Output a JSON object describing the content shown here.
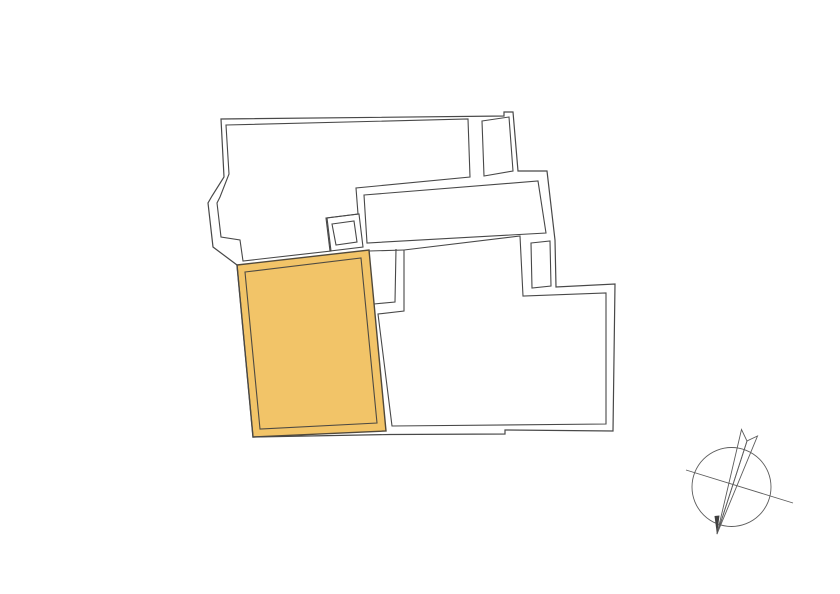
{
  "canvas": {
    "width": 840,
    "height": 594,
    "background": "#ffffff"
  },
  "colors": {
    "wall_stroke": "#484848",
    "highlight_fill": "#f2c468",
    "highlight_outer_stroke": "#51493a",
    "highlight_inner_stroke": "#4e4a42",
    "compass_stroke": "#5c5c5c",
    "compass_tip_fill": "#3f3f3f"
  },
  "floorplan": {
    "outer_boundary": {
      "closed": true,
      "points": [
        [
          221,
          119
        ],
        [
          504,
          116
        ],
        [
          504,
          112
        ],
        [
          513,
          112
        ],
        [
          518,
          171
        ],
        [
          547,
          171
        ],
        [
          555,
          240
        ],
        [
          556,
          287
        ],
        [
          615,
          284
        ],
        [
          613,
          431
        ],
        [
          505,
          430
        ],
        [
          505,
          434
        ],
        [
          390,
          434.5
        ],
        [
          253,
          437
        ],
        [
          237,
          265
        ],
        [
          213,
          247
        ],
        [
          208,
          203
        ],
        [
          212,
          196
        ],
        [
          224,
          177
        ]
      ]
    },
    "rooms": [
      {
        "name": "room-upper-left",
        "closed": true,
        "points": [
          [
            226,
            125
          ],
          [
            468,
            119
          ],
          [
            470,
            177
          ],
          [
            356,
            188
          ],
          [
            358,
            214
          ],
          [
            327,
            218
          ],
          [
            331,
            251
          ],
          [
            243,
            261
          ],
          [
            240,
            240
          ],
          [
            221,
            237
          ],
          [
            217,
            203
          ],
          [
            220,
            197
          ],
          [
            229,
            174
          ]
        ]
      },
      {
        "name": "room-top-right",
        "closed": true,
        "points": [
          [
            482,
            121
          ],
          [
            509,
            117
          ],
          [
            513,
            171
          ],
          [
            484,
            176
          ]
        ]
      },
      {
        "name": "room-middle-band",
        "closed": true,
        "points": [
          [
            364,
            195
          ],
          [
            538,
            181
          ],
          [
            546,
            233
          ],
          [
            367,
            243
          ]
        ]
      },
      {
        "name": "room-square-outer",
        "closed": true,
        "points": [
          [
            326,
            218
          ],
          [
            359,
            214
          ],
          [
            363,
            247
          ],
          [
            330,
            251
          ]
        ]
      },
      {
        "name": "room-square-inner",
        "closed": true,
        "points": [
          [
            332,
            224
          ],
          [
            354,
            221
          ],
          [
            357,
            242
          ],
          [
            336,
            245
          ]
        ]
      },
      {
        "name": "room-shaft",
        "closed": true,
        "points": [
          [
            531,
            243
          ],
          [
            550,
            241
          ],
          [
            551,
            286
          ],
          [
            532,
            288
          ]
        ]
      },
      {
        "name": "room-lower-right",
        "closed": true,
        "points": [
          [
            404,
            250
          ],
          [
            520,
            236
          ],
          [
            523,
            296
          ],
          [
            606,
            293
          ],
          [
            606,
            424
          ],
          [
            392,
            426
          ],
          [
            378,
            314
          ],
          [
            404,
            311
          ]
        ]
      }
    ],
    "wall_segments": [
      {
        "name": "wall-seg-band-bottom-left",
        "closed": false,
        "points": [
          [
            369,
            251
          ],
          [
            404,
            250
          ]
        ]
      },
      {
        "name": "wall-seg-stub-left",
        "closed": false,
        "points": [
          [
            374,
            304
          ],
          [
            395,
            302
          ],
          [
            396,
            249
          ]
        ]
      }
    ],
    "highlight_room": {
      "outer": {
        "closed": true,
        "points": [
          [
            237,
            265
          ],
          [
            369,
            250
          ],
          [
            386,
            431
          ],
          [
            253,
            437
          ]
        ]
      },
      "inner": {
        "closed": true,
        "points": [
          [
            245,
            272
          ],
          [
            361,
            258
          ],
          [
            377,
            423
          ],
          [
            260,
            429
          ]
        ]
      }
    }
  },
  "compass": {
    "center": [
      731.5,
      487
    ],
    "radius": 39.5,
    "cross_line": [
      [
        686,
        470
      ],
      [
        793,
        503
      ]
    ],
    "needle": {
      "tip": [
        717,
        534
      ],
      "left_prong": [
        741.5,
        429.5
      ],
      "right_prong": [
        757.5,
        436
      ],
      "notch": [
        747,
        441
      ]
    },
    "tip_fill_triangle": [
      [
        717,
        535
      ],
      [
        714.5,
        516
      ],
      [
        719.5,
        515.5
      ]
    ]
  }
}
